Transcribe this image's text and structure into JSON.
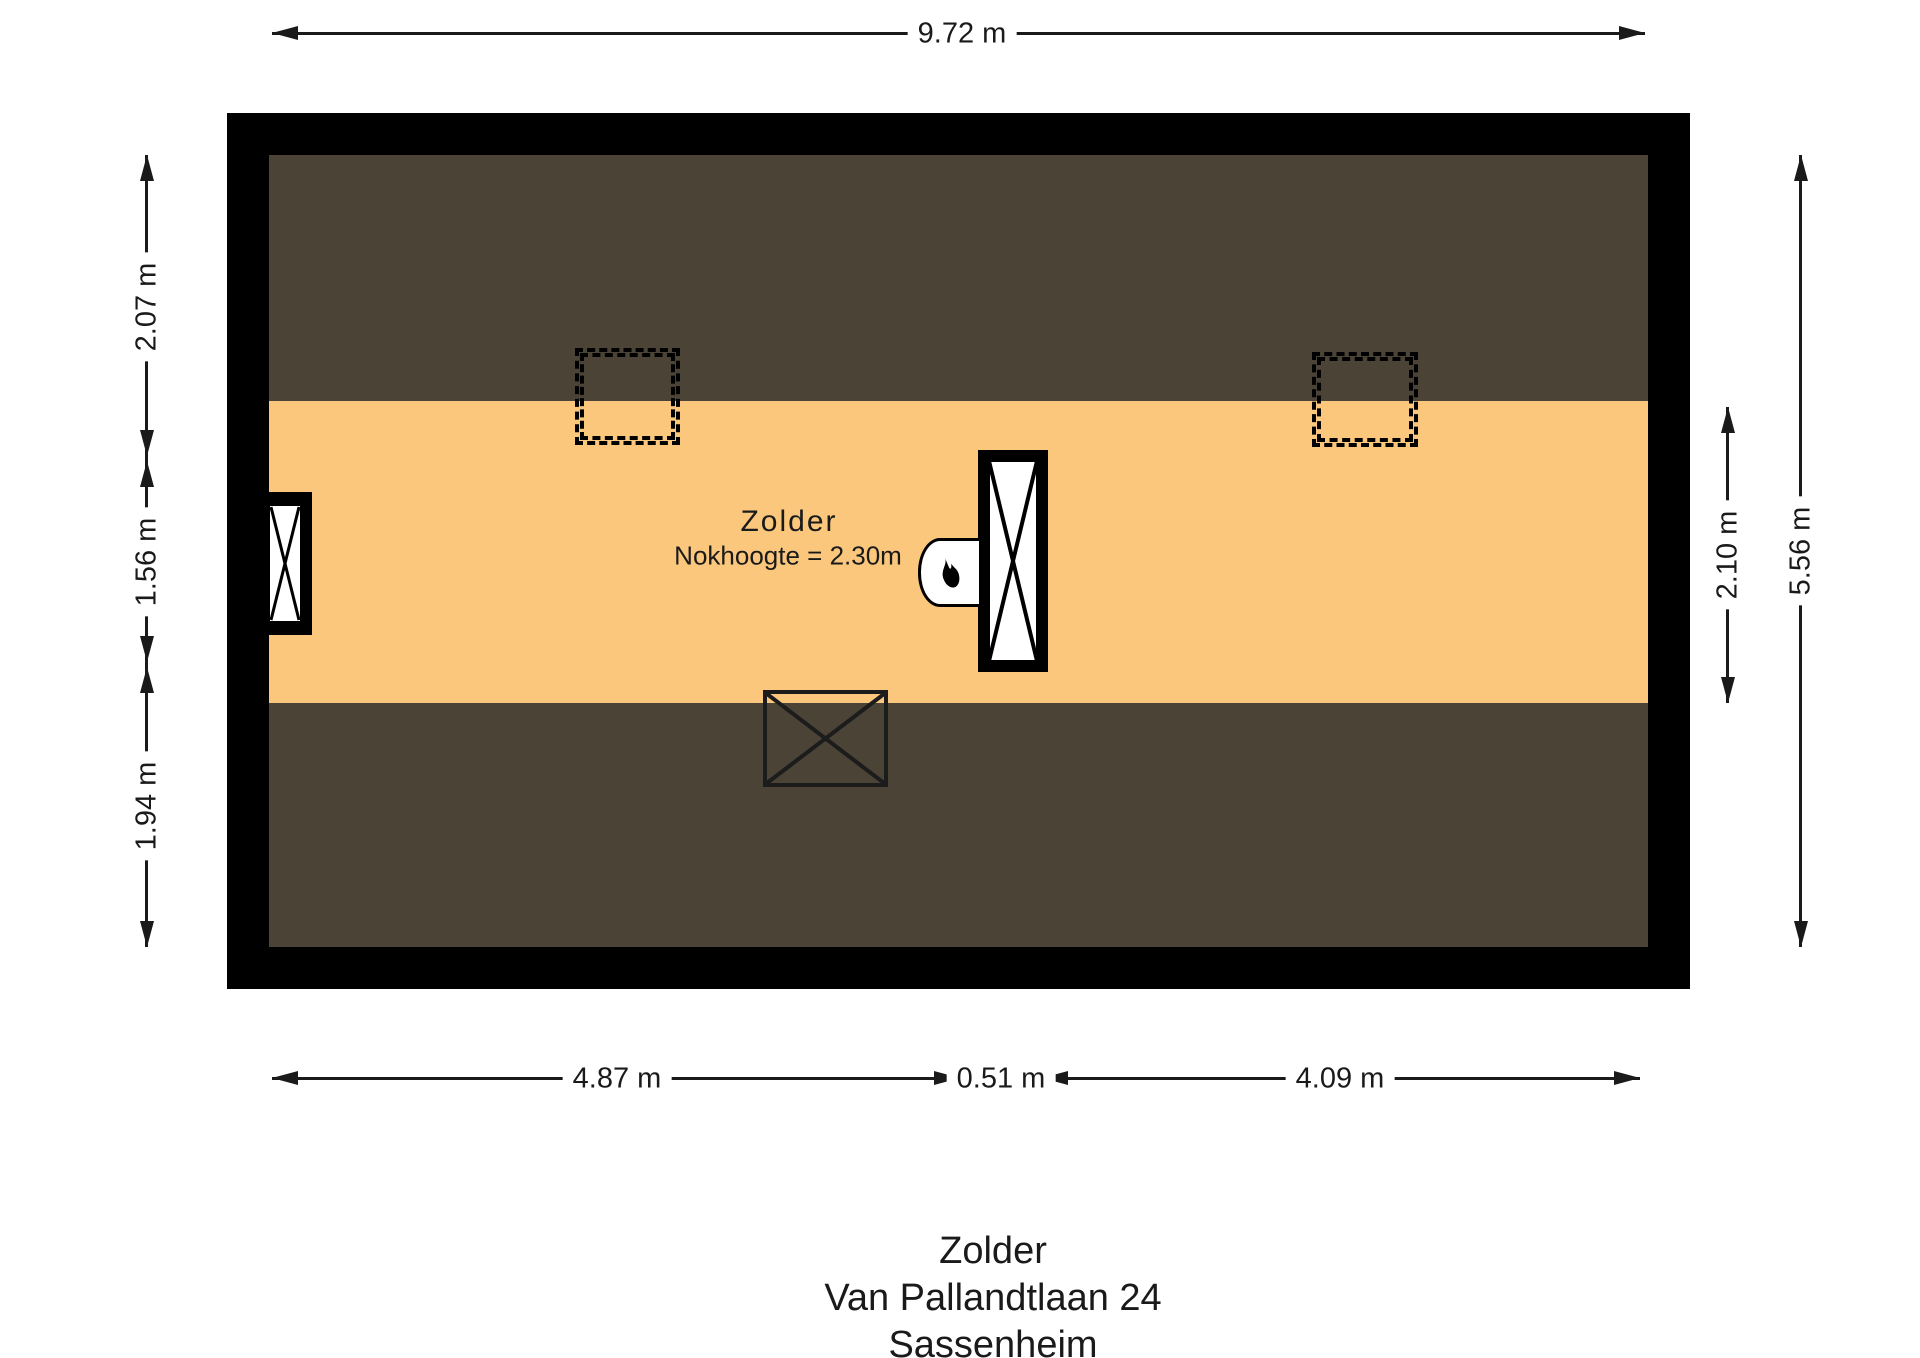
{
  "plan": {
    "room_label": "Zolder",
    "room_note": "Nokhoogte = 2.30m"
  },
  "dimensions": {
    "top": {
      "label": "9.72 m"
    },
    "bottom": {
      "seg1": "4.87 m",
      "seg2": "0.51 m",
      "seg3": "4.09 m"
    },
    "left": {
      "seg1": "2.07 m",
      "seg2": "1.56 m",
      "seg3": "1.94 m"
    },
    "right": {
      "inner": "2.10 m",
      "overall": "5.56 m"
    }
  },
  "footer": {
    "room": "Zolder",
    "street": "Van Pallandtlaan 24",
    "city": "Sassenheim"
  },
  "icons": {
    "boiler": "flame-icon",
    "window": "window-cross-icon",
    "chimney": "shaft-cross-icon",
    "stairwell": "stair-opening-cross-icon"
  },
  "colors": {
    "wall": "#000000",
    "floor": "#FAC77C",
    "slope": "#4B4335",
    "bg": "#FFFFFF",
    "ink": "#1A1A1A"
  }
}
